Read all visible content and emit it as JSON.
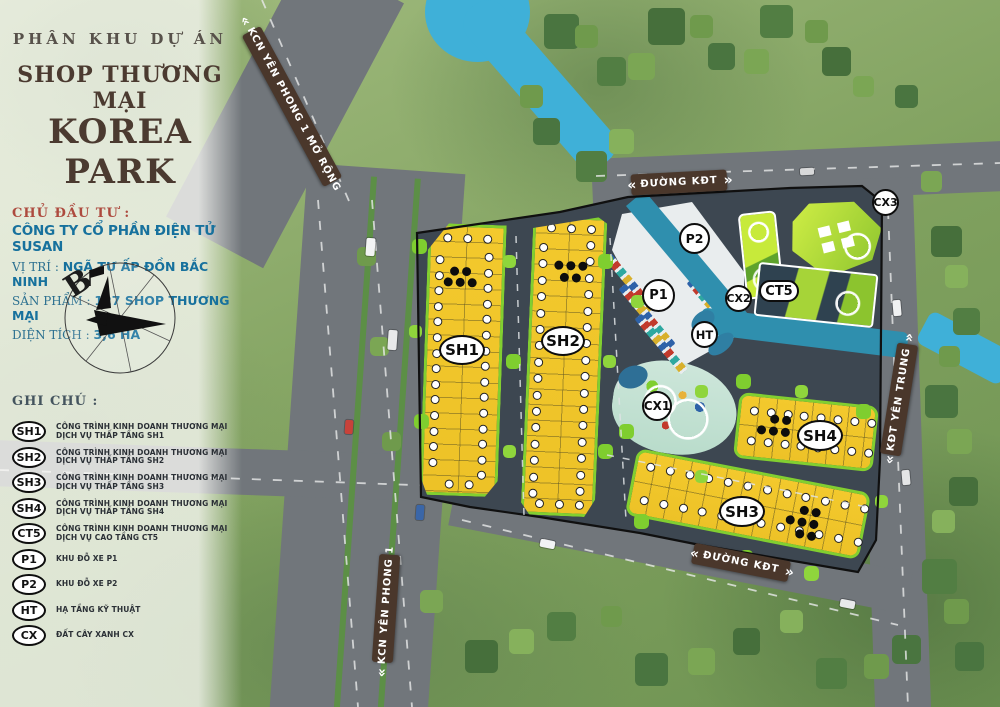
{
  "project": {
    "kicker": "PHÂN KHU DỰ ÁN",
    "subtitle": "SHOP THƯƠNG MẠI",
    "title": "KOREA PARK",
    "investor_label": "CHỦ ĐẦU TƯ :",
    "investor": "CÔNG TY CỔ PHẦN ĐIỆN TỬ SUSAN",
    "location_label": "VỊ TRÍ :",
    "location": "NGÃ TƯ ẤP ĐỒN BẮC NINH",
    "product_label": "SẢN PHẨM :",
    "product": "127  SHOP THƯƠNG MẠI",
    "area_label": "DIỆN TÍCH :",
    "area": "3,6 HA"
  },
  "legend": {
    "title": "GHI CHÚ :",
    "items": [
      {
        "code": "SH1",
        "label": "CÔNG TRÌNH KINH DOANH THƯƠNG MẠI DỊCH VỤ THẤP TẦNG SH1"
      },
      {
        "code": "SH2",
        "label": "CÔNG TRÌNH KINH DOANH THƯƠNG MẠI DỊCH VỤ THẤP TẦNG SH2"
      },
      {
        "code": "SH3",
        "label": "CÔNG TRÌNH KINH DOANH THƯƠNG MẠI DỊCH VỤ THẤP TẦNG SH3"
      },
      {
        "code": "SH4",
        "label": "CÔNG TRÌNH KINH DOANH THƯƠNG MẠI DỊCH VỤ THẤP TẦNG SH4"
      },
      {
        "code": "CT5",
        "label": "CÔNG TRÌNH KINH DOANH THƯƠNG MẠI DỊCH VỤ CAO TẦNG CT5"
      },
      {
        "code": "P1",
        "label": "KHU ĐỖ XE P1"
      },
      {
        "code": "P2",
        "label": "KHU ĐỖ XE P2"
      },
      {
        "code": "HT",
        "label": "HẠ TẦNG KỸ THUẬT"
      },
      {
        "code": "CX",
        "label": "ĐẤT CÂY XANH CX"
      }
    ]
  },
  "roads": {
    "banners": [
      {
        "id": "kcn-yen-phong-1-mo-rong",
        "lead": "«",
        "text": "KCN YÊN PHONG 1 MỞ RỘNG",
        "trail": ""
      },
      {
        "id": "duong-kdt-top",
        "lead": "«",
        "text": "ĐƯỜNG KĐT",
        "trail": "»"
      },
      {
        "id": "kdt-yen-trung",
        "lead": "«",
        "text": "KĐT YÊN TRUNG",
        "trail": "»"
      },
      {
        "id": "duong-kdt-bottom",
        "lead": "«",
        "text": "ĐƯỜNG KĐT",
        "trail": "»"
      },
      {
        "id": "kcn-yen-phong-1",
        "lead": "«",
        "text": "KCN YÊN PHONG 1",
        "trail": ""
      }
    ]
  },
  "map": {
    "compass_label": "B",
    "badges": [
      {
        "id": "sh1",
        "label": "SH1"
      },
      {
        "id": "sh2",
        "label": "SH2"
      },
      {
        "id": "sh3",
        "label": "SH3"
      },
      {
        "id": "sh4",
        "label": "SH4"
      },
      {
        "id": "ct5",
        "label": "CT5"
      },
      {
        "id": "p1",
        "label": "P1"
      },
      {
        "id": "p2",
        "label": "P2"
      },
      {
        "id": "ht",
        "label": "HT"
      },
      {
        "id": "cx1",
        "label": "CX1"
      },
      {
        "id": "cx2",
        "label": "CX2"
      },
      {
        "id": "cx3",
        "label": "CX3"
      }
    ]
  },
  "colors": {
    "title_brown": "#4b3a30",
    "info_blue": "#17719d",
    "investor_red": "#ad4a3e",
    "banner_brown": "#4a372b",
    "lot_yellow": "#f2c82c",
    "lime_green": "#82cf30",
    "water_blue": "#3fb0d8",
    "site_asphalt": "#3d4751",
    "sold_dot": "#0d0d0d"
  }
}
